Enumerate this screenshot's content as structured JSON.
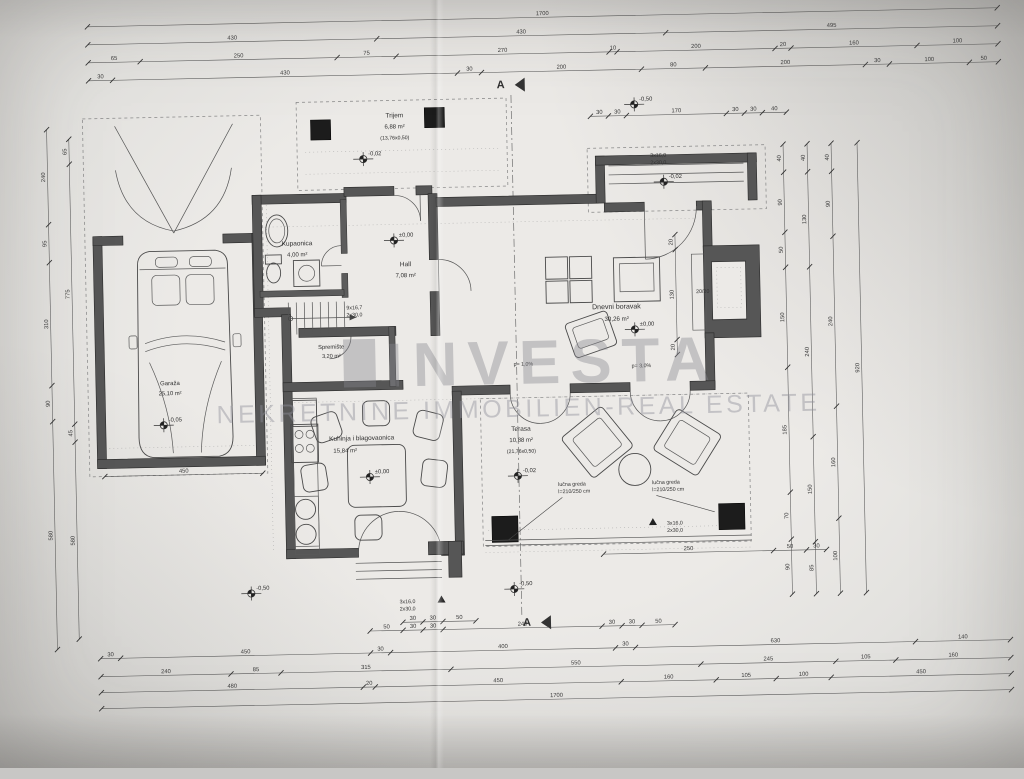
{
  "watermark": {
    "logo": "INVESTA",
    "subtitle": "NEKRETNINE IMMOBILIEN-REAL ESTATE"
  },
  "section_marker": "A",
  "rooms": {
    "trijem": {
      "name": "Trijem",
      "area": "6,88 m²",
      "note": "(13,76x0,50)"
    },
    "kupaonica": {
      "name": "Kupaonica",
      "area": "4,00 m²"
    },
    "hall": {
      "name": "Hall",
      "area": "7,08 m²"
    },
    "spremiste": {
      "name": "Spremište",
      "area": "3,20 m²"
    },
    "dnevni": {
      "name": "Dnevni boravak",
      "area": "30,26 m²"
    },
    "kuhinja": {
      "name": "Kuhinja i blagovaonica",
      "area": "15,84 m²"
    },
    "terasa": {
      "name": "Terasa",
      "area": "10,88 m²",
      "note": "(21,76x0,50)"
    },
    "garaza": {
      "name": "Garaža",
      "area": "25,10 m²"
    }
  },
  "levels": [
    {
      "x": 368,
      "y": 156,
      "t": "-0,02"
    },
    {
      "x": 397,
      "y": 238,
      "t": "±0,00"
    },
    {
      "x": 636,
      "y": 332,
      "t": "±0,00"
    },
    {
      "x": 368,
      "y": 474,
      "t": "±0,00"
    },
    {
      "x": 516,
      "y": 476,
      "t": "-0,02"
    },
    {
      "x": 163,
      "y": 418,
      "t": "-0,05"
    },
    {
      "x": 640,
      "y": 107,
      "t": "-0,50"
    },
    {
      "x": 668,
      "y": 185,
      "t": "-0,02"
    },
    {
      "x": 247,
      "y": 588,
      "t": "-0,50"
    },
    {
      "x": 510,
      "y": 589,
      "t": "-0,50"
    }
  ],
  "notes": [
    {
      "x": 655,
      "y": 160,
      "lines": [
        "3x16,0",
        "2x30,0"
      ]
    },
    {
      "x": 395,
      "y": 601,
      "lines": [
        "3x16,0",
        "2x30,0"
      ],
      "tri": [
        437,
        597
      ]
    },
    {
      "x": 664,
      "y": 528,
      "lines": [
        "3x16,0",
        "2x30,0"
      ],
      "tri": [
        650,
        524
      ]
    },
    {
      "x": 556,
      "y": 487,
      "lines": [
        "lučna greda",
        "l=210/250 cm"
      ],
      "lead": [
        505,
        540
      ]
    },
    {
      "x": 650,
      "y": 487,
      "lines": [
        "lučna greda",
        "l=210/250 cm"
      ],
      "lead": [
        712,
        516
      ]
    },
    {
      "x": 698,
      "y": 297,
      "lines": [
        "20/20"
      ]
    },
    {
      "x": 514,
      "y": 366,
      "lines": [
        "p= 1,0%"
      ]
    },
    {
      "x": 632,
      "y": 370,
      "lines": [
        "p= 3,0%"
      ]
    },
    {
      "x": 348,
      "y": 306,
      "lines": [
        "9x16,7",
        "2x30,0"
      ]
    }
  ],
  "dim_chains": [
    {
      "o": "h",
      "x": 95,
      "y": 18,
      "s": [
        [
          910,
          "1700"
        ]
      ]
    },
    {
      "o": "h",
      "x": 95,
      "y": 36,
      "s": [
        [
          289,
          "430"
        ],
        [
          289,
          "430"
        ],
        [
          332,
          "495"
        ]
      ]
    },
    {
      "o": "h",
      "x": 95,
      "y": 54,
      "s": [
        [
          52,
          "65"
        ],
        [
          197,
          "250"
        ],
        [
          59,
          "75"
        ],
        [
          213,
          "270"
        ],
        [
          8,
          "10"
        ],
        [
          158,
          "200"
        ],
        [
          16,
          "20"
        ],
        [
          126,
          "160"
        ],
        [
          81,
          "100"
        ]
      ]
    },
    {
      "o": "h",
      "x": 95,
      "y": 72,
      "s": [
        [
          24,
          "30"
        ],
        [
          345,
          "430"
        ],
        [
          24,
          "30"
        ],
        [
          160,
          "200"
        ],
        [
          64,
          "80"
        ],
        [
          160,
          "200"
        ],
        [
          24,
          "30"
        ],
        [
          80,
          "100"
        ],
        [
          29,
          "50"
        ]
      ]
    },
    {
      "o": "h",
      "x": 596,
      "y": 118,
      "s": [
        [
          18,
          "30"
        ],
        [
          18,
          "30"
        ],
        [
          100,
          "170"
        ],
        [
          18,
          "30"
        ],
        [
          18,
          "30"
        ],
        [
          24,
          "40"
        ]
      ]
    },
    {
      "o": "h",
      "x": 365,
      "y": 628,
      "s": [
        [
          33,
          "50"
        ],
        [
          20,
          "30"
        ],
        [
          20,
          "30"
        ],
        [
          159,
          "240"
        ],
        [
          20,
          "30"
        ],
        [
          20,
          "30"
        ],
        [
          33,
          "50"
        ]
      ]
    },
    {
      "o": "h",
      "x": 95,
      "y": 650,
      "s": [
        [
          20,
          "30"
        ],
        [
          250,
          "450"
        ],
        [
          20,
          "30"
        ],
        [
          225,
          "400"
        ],
        [
          20,
          "30"
        ],
        [
          280,
          "630"
        ],
        [
          95,
          "140"
        ]
      ]
    },
    {
      "o": "h",
      "x": 95,
      "y": 668,
      "s": [
        [
          130,
          "240"
        ],
        [
          50,
          "85"
        ],
        [
          170,
          "315"
        ],
        [
          250,
          "550"
        ],
        [
          135,
          "245"
        ],
        [
          60,
          "105"
        ],
        [
          115,
          "160"
        ]
      ]
    },
    {
      "o": "h",
      "x": 95,
      "y": 684,
      "s": [
        [
          262,
          "480"
        ],
        [
          12,
          "20"
        ],
        [
          246,
          "450"
        ],
        [
          95,
          "160"
        ],
        [
          60,
          "105"
        ],
        [
          55,
          "100"
        ],
        [
          180,
          "450"
        ]
      ]
    },
    {
      "o": "h",
      "x": 95,
      "y": 700,
      "s": [
        [
          910,
          "1700"
        ]
      ]
    },
    {
      "o": "v",
      "x": 52,
      "y": 120,
      "s": [
        [
          95,
          "240"
        ],
        [
          38,
          "95"
        ],
        [
          123,
          "310"
        ],
        [
          36,
          "90"
        ],
        [
          228,
          "580"
        ]
      ]
    },
    {
      "o": "v",
      "x": 74,
      "y": 130,
      "s": [
        [
          25,
          "65"
        ],
        [
          260,
          "775"
        ],
        [
          18,
          "45"
        ],
        [
          197,
          "580"
        ]
      ]
    },
    {
      "o": "v",
      "x": 788,
      "y": 150,
      "s": [
        [
          28,
          "40"
        ],
        [
          60,
          "90"
        ],
        [
          35,
          "50"
        ],
        [
          100,
          "150"
        ],
        [
          125,
          "185"
        ],
        [
          47,
          "70"
        ],
        [
          55,
          "90"
        ]
      ]
    },
    {
      "o": "v",
      "x": 812,
      "y": 150,
      "s": [
        [
          28,
          "40"
        ],
        [
          95,
          "130"
        ],
        [
          170,
          "240"
        ],
        [
          105,
          "150"
        ],
        [
          52,
          "85"
        ]
      ]
    },
    {
      "o": "v",
      "x": 836,
      "y": 150,
      "s": [
        [
          28,
          "40"
        ],
        [
          65,
          "90"
        ],
        [
          170,
          "240"
        ],
        [
          112,
          "160"
        ],
        [
          75,
          "100"
        ]
      ]
    },
    {
      "o": "v",
      "x": 862,
      "y": 150,
      "s": [
        [
          450,
          "920"
        ]
      ]
    },
    {
      "o": "h",
      "x": 600,
      "y": 556,
      "s": [
        [
          170,
          "250"
        ],
        [
          33,
          "50"
        ],
        [
          20,
          "30"
        ]
      ]
    },
    {
      "o": "h",
      "x": 398,
      "y": 620,
      "s": [
        [
          20,
          "30"
        ],
        [
          20,
          "30"
        ],
        [
          33,
          "50"
        ]
      ]
    },
    {
      "o": "h",
      "x": 103,
      "y": 468,
      "s": [
        [
          158,
          "450"
        ]
      ]
    },
    {
      "o": "v",
      "x": 678,
      "y": 238,
      "s": [
        [
          15,
          "20"
        ],
        [
          90,
          "130"
        ],
        [
          15,
          "20"
        ]
      ]
    }
  ]
}
